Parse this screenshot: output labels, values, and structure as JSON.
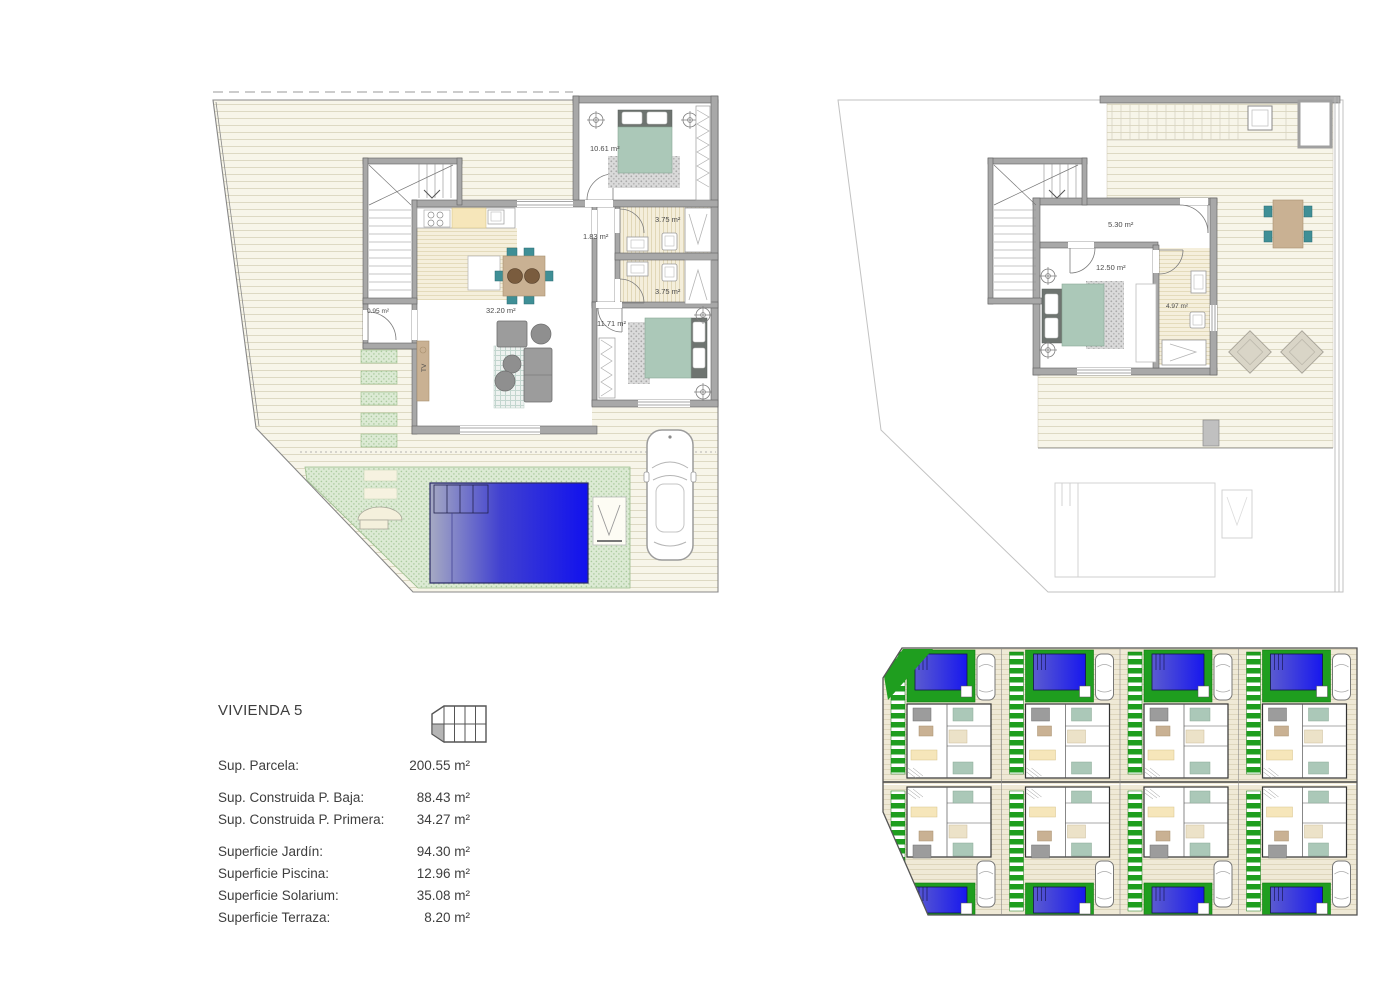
{
  "sheet": {
    "background": "#ffffff"
  },
  "info_panel": {
    "title": "VIVIENDA 5",
    "rows": [
      {
        "label": "Sup. Parcela:",
        "value": "200.55 m²"
      },
      {
        "label": "Sup. Construida P. Baja:",
        "value": "88.43 m²"
      },
      {
        "label": "Sup. Construida P. Primera:",
        "value": "34.27 m²"
      },
      {
        "label": "Superficie Jardín:",
        "value": "94.30 m²"
      },
      {
        "label": "Superficie Piscina:",
        "value": "12.96 m²"
      },
      {
        "label": "Superficie Solarium:",
        "value": "35.08 m²"
      },
      {
        "label": "Superficie Terraza:",
        "value": "8.20 m²"
      }
    ],
    "key_plan": {
      "total_units": 8,
      "rows": 2,
      "columns": 4,
      "highlighted_unit": 5
    }
  },
  "ground_floor": {
    "labels": {
      "living": "32.20 m²",
      "bedroom1": "10.61 m²",
      "bedroom2": "11.71 m²",
      "bath1": "3.75 m²",
      "bath2": "3.75 m²",
      "hall": "1.83 m²",
      "closet": "0.95 m²",
      "tv_unit": "TV"
    }
  },
  "first_floor": {
    "labels": {
      "hall": "5.30 m²",
      "bedroom": "12.50 m²",
      "bath": "4.97 m²"
    }
  },
  "site_plan": {
    "total_units": 8,
    "rows": 2,
    "columns": 4
  },
  "colors": {
    "wall_gray": "#a8a8a8",
    "deck_cream": "#f7f5e9",
    "pool_blue": "#1111ee",
    "garden_green": "#dcead4",
    "site_green": "#1f9e1f",
    "bed_sage": "#abc8b8",
    "chair_teal": "#3f8f96",
    "table_tan": "#c9b193",
    "furniture_gray": "#9c9c9c",
    "kitchen_yellow": "#f6e6ba"
  }
}
